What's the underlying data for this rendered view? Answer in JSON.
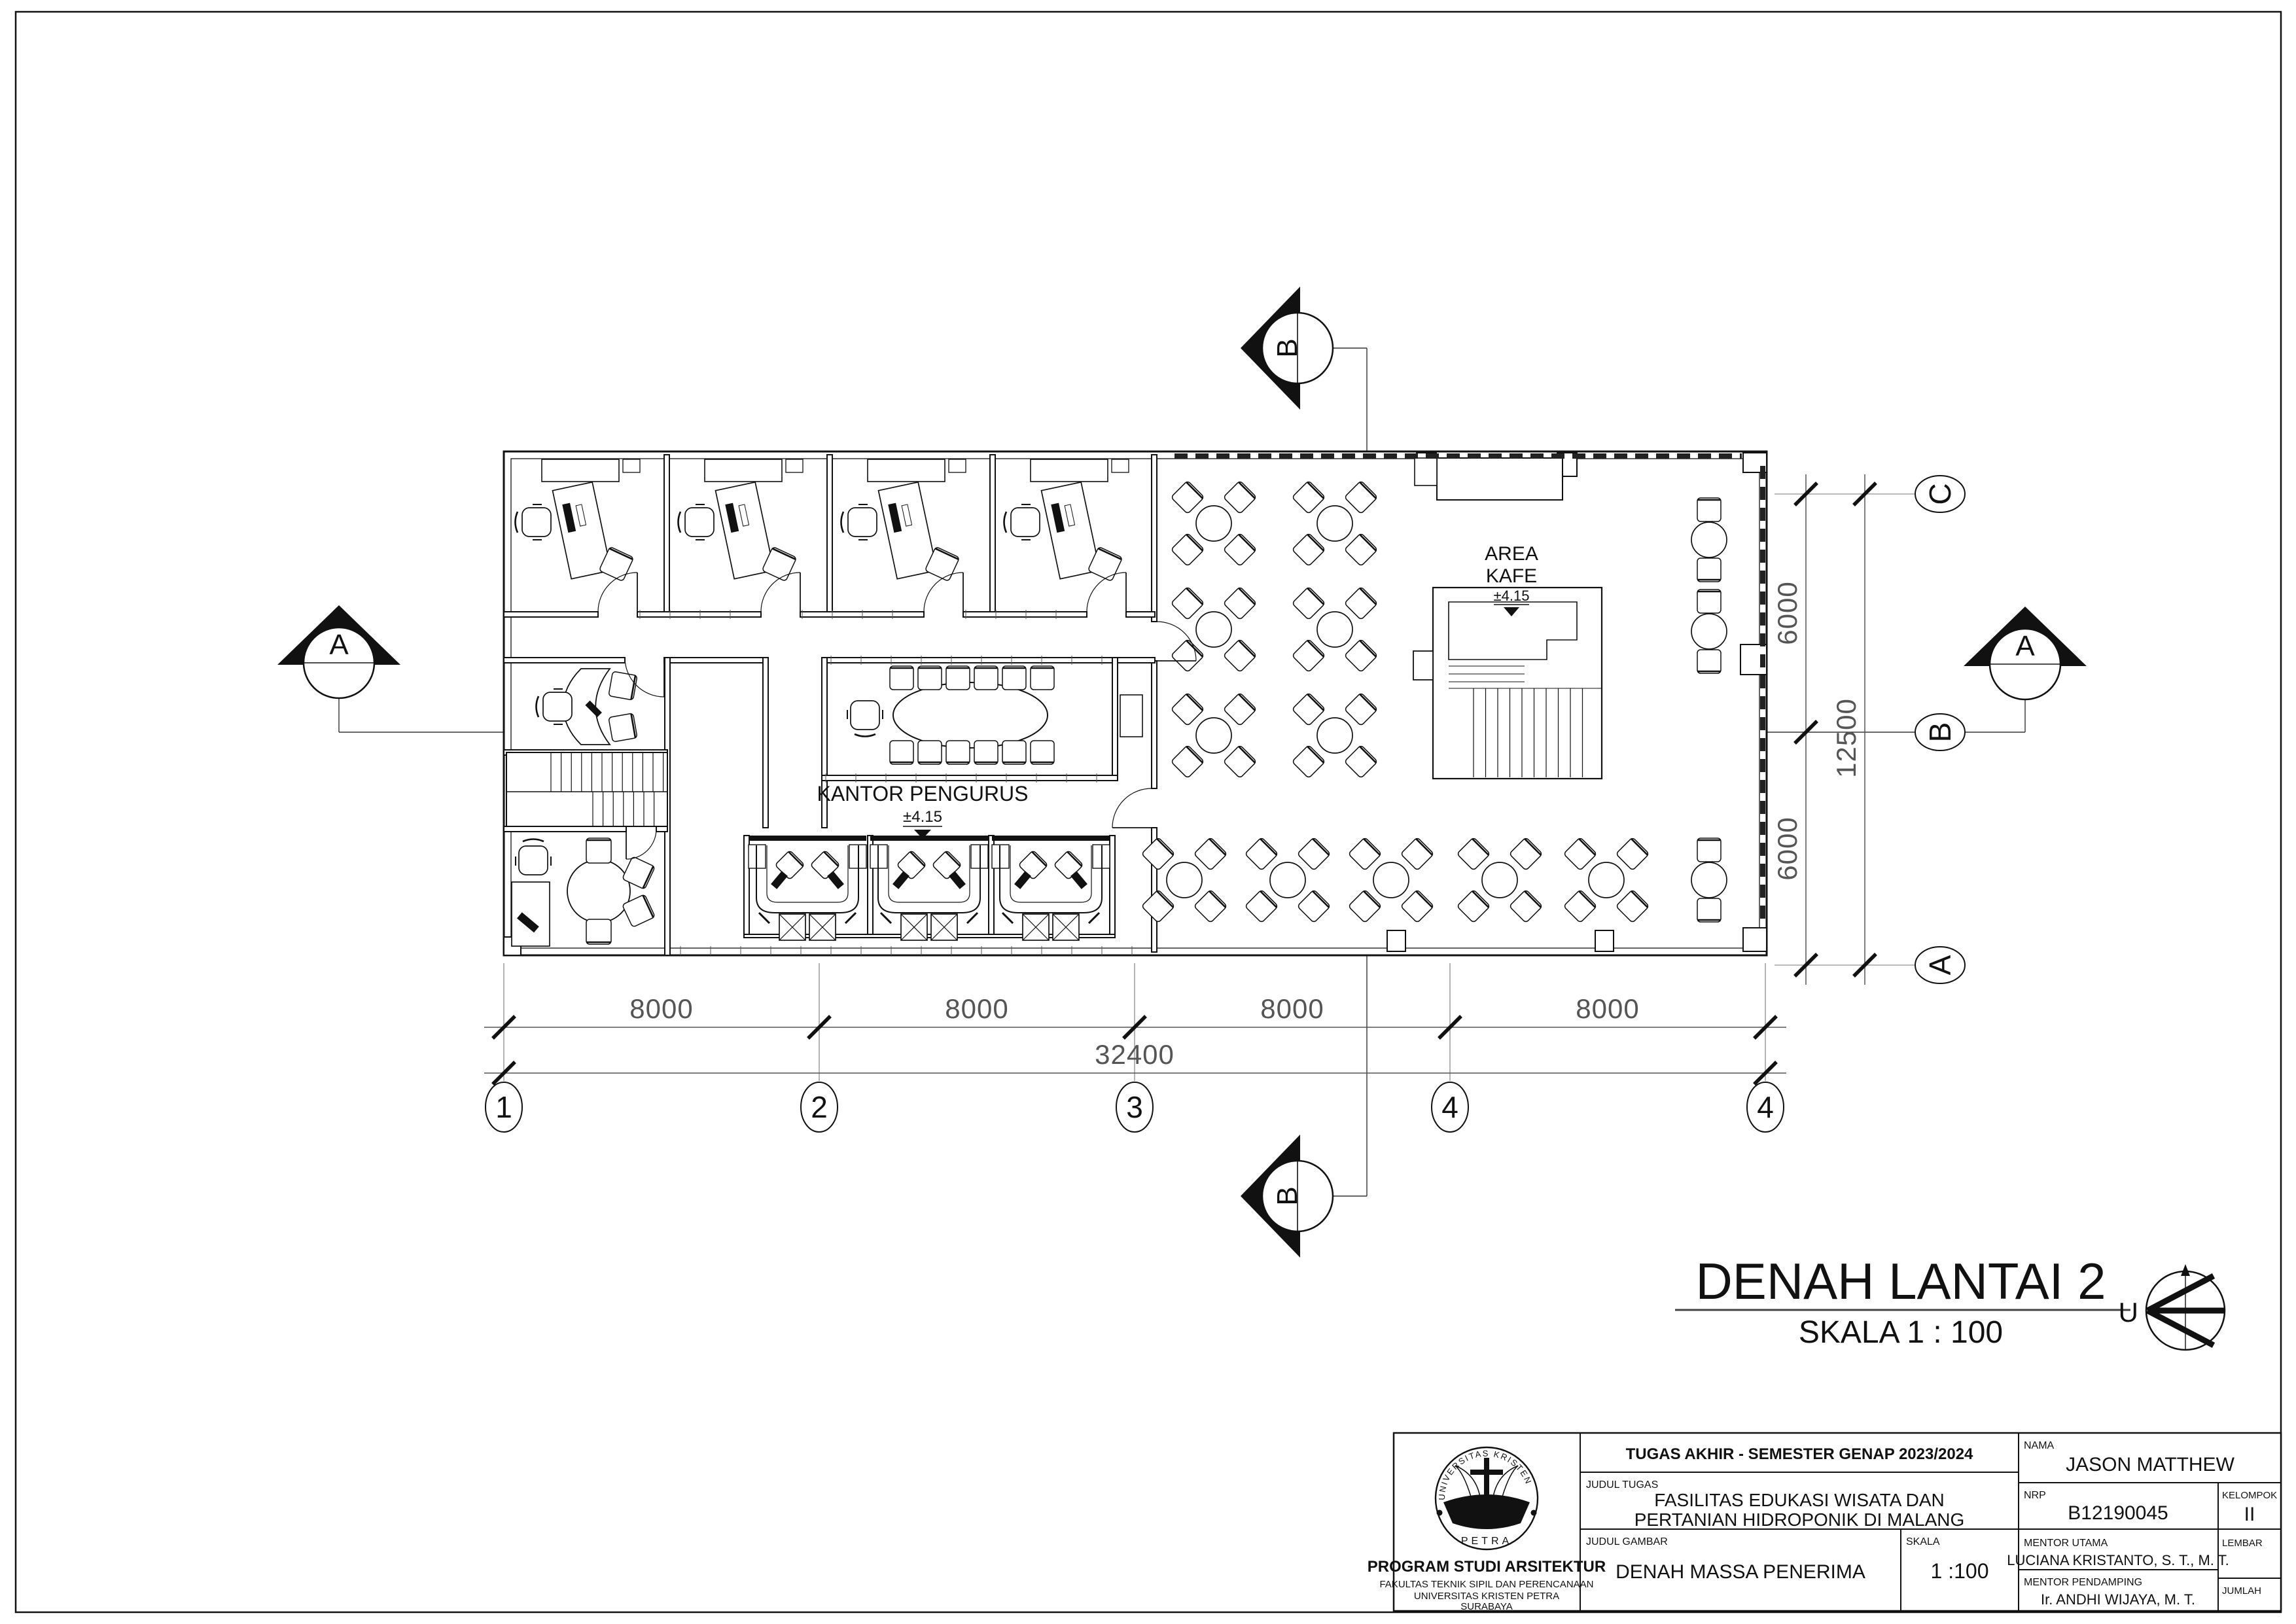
{
  "sheet": {
    "title": "DENAH LANTAI 2",
    "scale_caption": "SKALA 1 : 100",
    "north_label": "U"
  },
  "plan_labels": {
    "kantor_pengurus": {
      "name": "KANTOR PENGURUS",
      "level": "±4.15"
    },
    "area_kafe": {
      "line1": "AREA",
      "line2": "KAFE",
      "level": "±4.15"
    }
  },
  "grid": {
    "bottom_bubbles": [
      "1",
      "2",
      "3",
      "4",
      "4"
    ],
    "right_bubbles": [
      "C",
      "B",
      "A"
    ]
  },
  "dimensions": {
    "bottom_segments": [
      "8000",
      "8000",
      "8000",
      "8000"
    ],
    "bottom_total": "32400",
    "right_segments": [
      "6000",
      "6000"
    ],
    "right_total": "12500"
  },
  "section_markers": {
    "horizontal": "A",
    "vertical": "B"
  },
  "title_block": {
    "header": "TUGAS AKHIR - SEMESTER GENAP 2023/2024",
    "judul_tugas_label": "JUDUL TUGAS",
    "judul_tugas_line1": "FASILITAS EDUKASI WISATA DAN",
    "judul_tugas_line2": "PERTANIAN HIDROPONIK DI MALANG",
    "judul_gambar_label": "JUDUL GAMBAR",
    "judul_gambar": "DENAH MASSA PENERIMA",
    "skala_label": "SKALA",
    "skala_value": "1 :100",
    "nama_label": "NAMA",
    "nama": "JASON MATTHEW",
    "nrp_label": "NRP",
    "nrp": "B12190045",
    "kelompok_label": "KELOMPOK",
    "kelompok": "II",
    "mentor_utama_label": "MENTOR UTAMA",
    "mentor_utama": "LUCIANA KRISTANTO, S. T., M. T.",
    "lembar_label": "LEMBAR",
    "mentor_pendamping_label": "MENTOR PENDAMPING",
    "mentor_pendamping": "Ir. ANDHI WIJAYA, M. T.",
    "jumlah_label": "JUMLAH",
    "institution": {
      "program": "PROGRAM STUDI ARSITEKTUR",
      "fakultas": "FAKULTAS TEKNIK SIPIL DAN PERENCANAAN",
      "universitas": "UNIVERSITAS KRISTEN PETRA",
      "kota": "SURABAYA",
      "logo_top": "UNIVERSITAS KRISTEN",
      "logo_bottom": "PETRA"
    }
  }
}
